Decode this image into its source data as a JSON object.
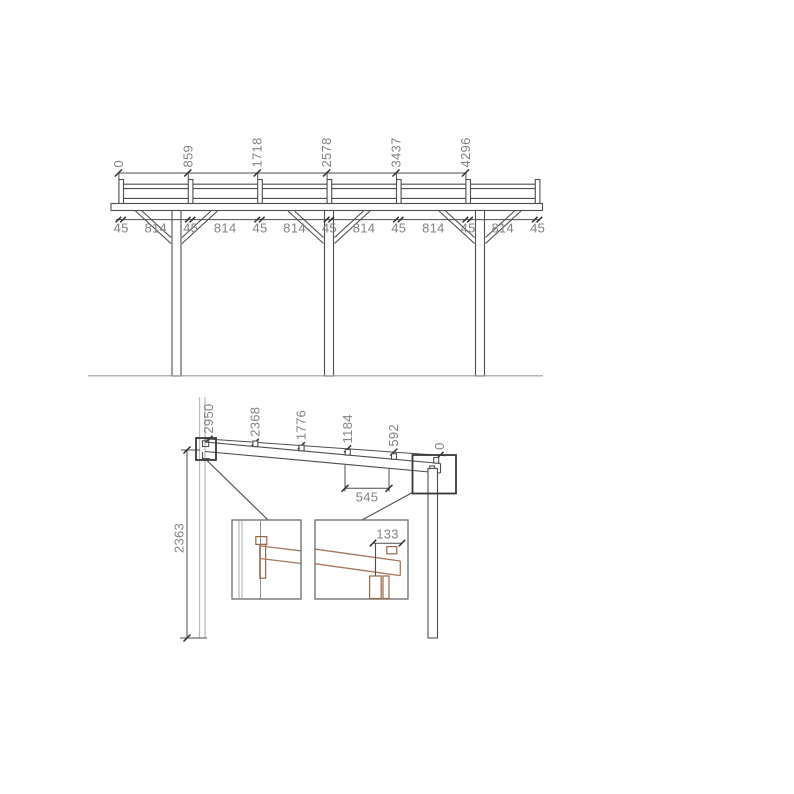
{
  "front_elevation": {
    "top_dimensions": [
      "0",
      "859",
      "1718",
      "2578",
      "3437",
      "4296"
    ],
    "bottom_dimensions": [
      "45",
      "814",
      "45",
      "814",
      "45",
      "814",
      "45",
      "814",
      "45",
      "814",
      "45",
      "814",
      "45"
    ]
  },
  "side_elevation": {
    "rafter_dimensions": [
      "2950",
      "2368",
      "1776",
      "1184",
      "592",
      "0"
    ],
    "height_dimension": "2363",
    "purlin_spacing_dimension": "545",
    "detail_dimension": "133"
  },
  "colors": {
    "line": "#4d4d4d",
    "dimension_text": "#828282",
    "wood": "#a5795b",
    "wall": "#bdbdbd"
  }
}
